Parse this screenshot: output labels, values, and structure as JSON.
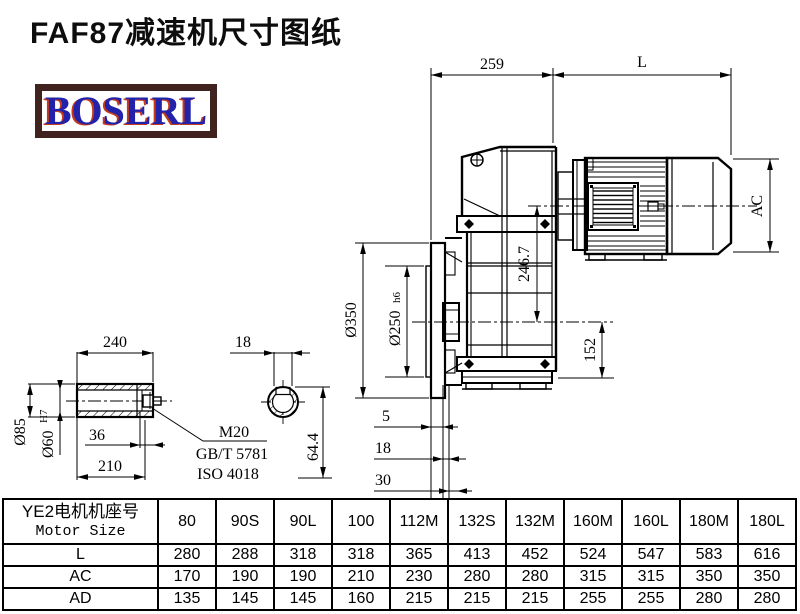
{
  "title": "FAF87减速机尺寸图纸",
  "logo": {
    "text": "BOSERL"
  },
  "drawing": {
    "dims": {
      "d259": "259",
      "dL": "L",
      "dAC": "AC",
      "d2467": "246.7",
      "d350": "Ø350",
      "d250": "Ø250",
      "d250_suffix": "h6",
      "d152": "152",
      "d5": "5",
      "d18_flange": "18",
      "d30": "30",
      "d240": "240",
      "d18_key": "18",
      "d85": "Ø85",
      "d60": "Ø60",
      "d60_sup": "H7",
      "d36": "36",
      "d210": "210",
      "d644": "64.4",
      "m20": "M20",
      "gbt": "GB/T 5781",
      "iso": "ISO 4018"
    }
  },
  "table": {
    "header_cn": "YE2电机机座号",
    "header_en": "Motor Size",
    "columns": [
      "80",
      "90S",
      "90L",
      "100",
      "112M",
      "132S",
      "132M",
      "160M",
      "160L",
      "180M",
      "180L"
    ],
    "rows": [
      {
        "label": "L",
        "values": [
          "280",
          "288",
          "318",
          "318",
          "365",
          "413",
          "452",
          "524",
          "547",
          "583",
          "616"
        ]
      },
      {
        "label": "AC",
        "values": [
          "170",
          "190",
          "190",
          "210",
          "230",
          "280",
          "280",
          "315",
          "315",
          "350",
          "350"
        ]
      },
      {
        "label": "AD",
        "values": [
          "135",
          "145",
          "145",
          "160",
          "215",
          "215",
          "215",
          "255",
          "255",
          "280",
          "280"
        ]
      }
    ]
  }
}
